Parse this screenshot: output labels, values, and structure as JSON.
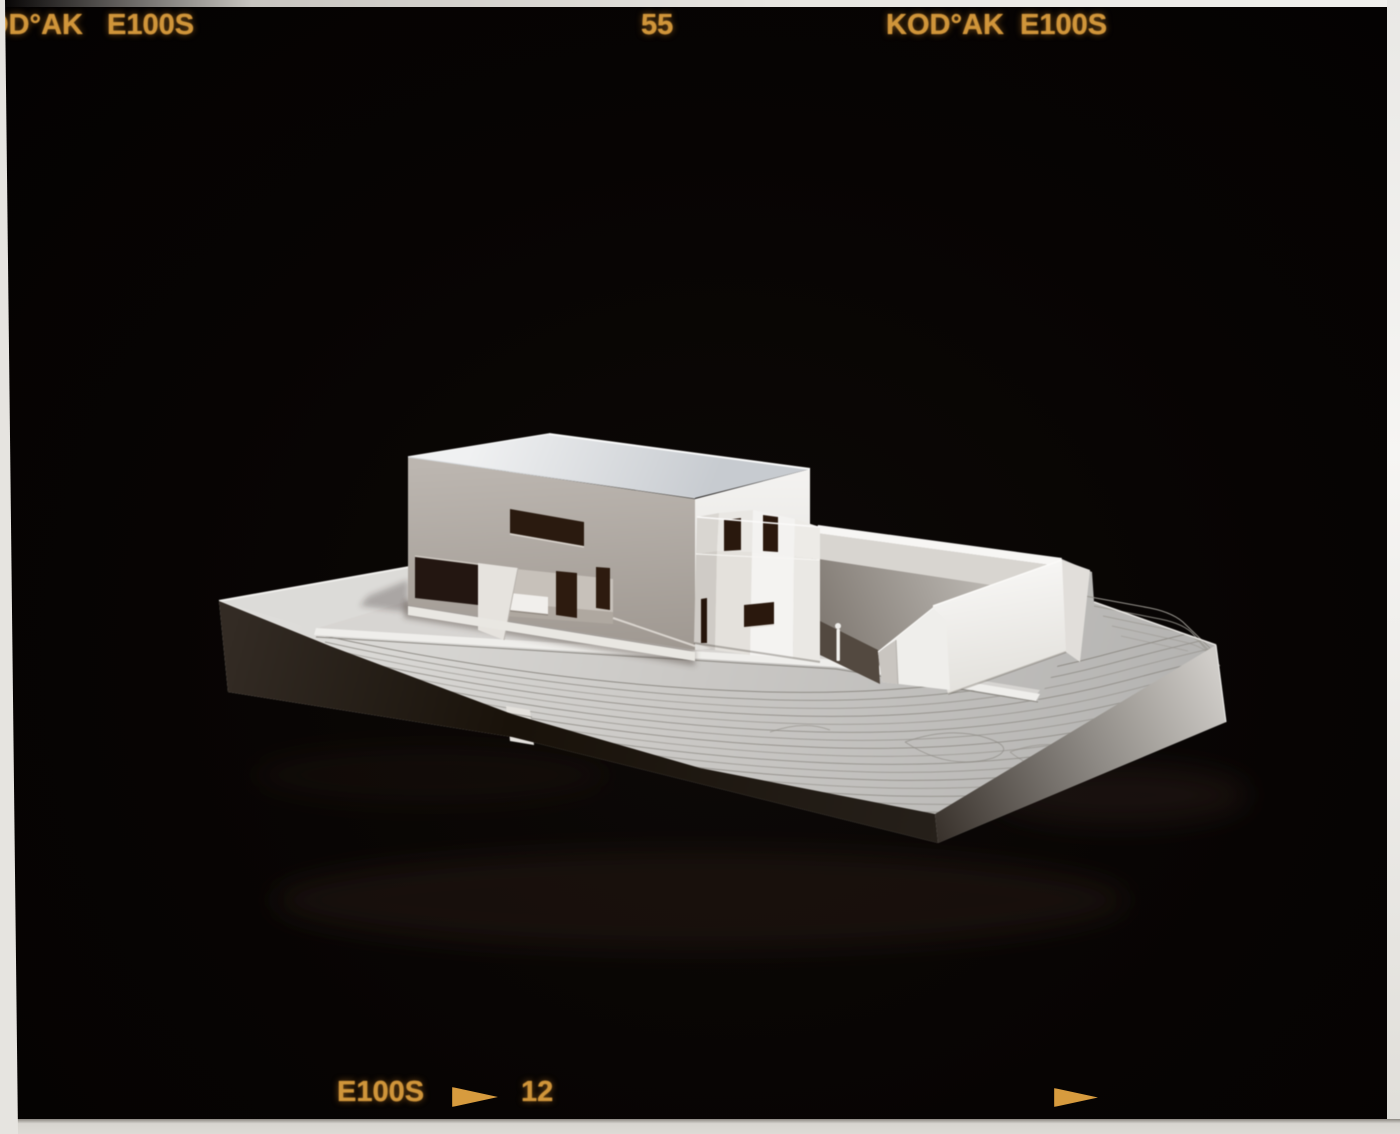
{
  "film": {
    "markings": {
      "top_left_brand": "OD°AK",
      "top_left_stock": "E100S",
      "frame_number_top": "55",
      "top_right_brand": "KOD°AK",
      "top_right_stock": "E100S",
      "bottom_stock": "E100S",
      "frame_number_bottom": "12"
    },
    "icons": {
      "bottom_index_arrow": "right-triangle-arrow",
      "bottom_edge_arrow": "right-triangle-arrow"
    },
    "colors": {
      "edge_marking_amber": "#d79b3e",
      "film_base_black": "#070403",
      "scan_border_white": "#e9e7e3"
    }
  },
  "photo": {
    "colors": {
      "model_white": "#efeeec",
      "model_shadow_gray": "#a39c94",
      "background_black": "#070403"
    }
  }
}
